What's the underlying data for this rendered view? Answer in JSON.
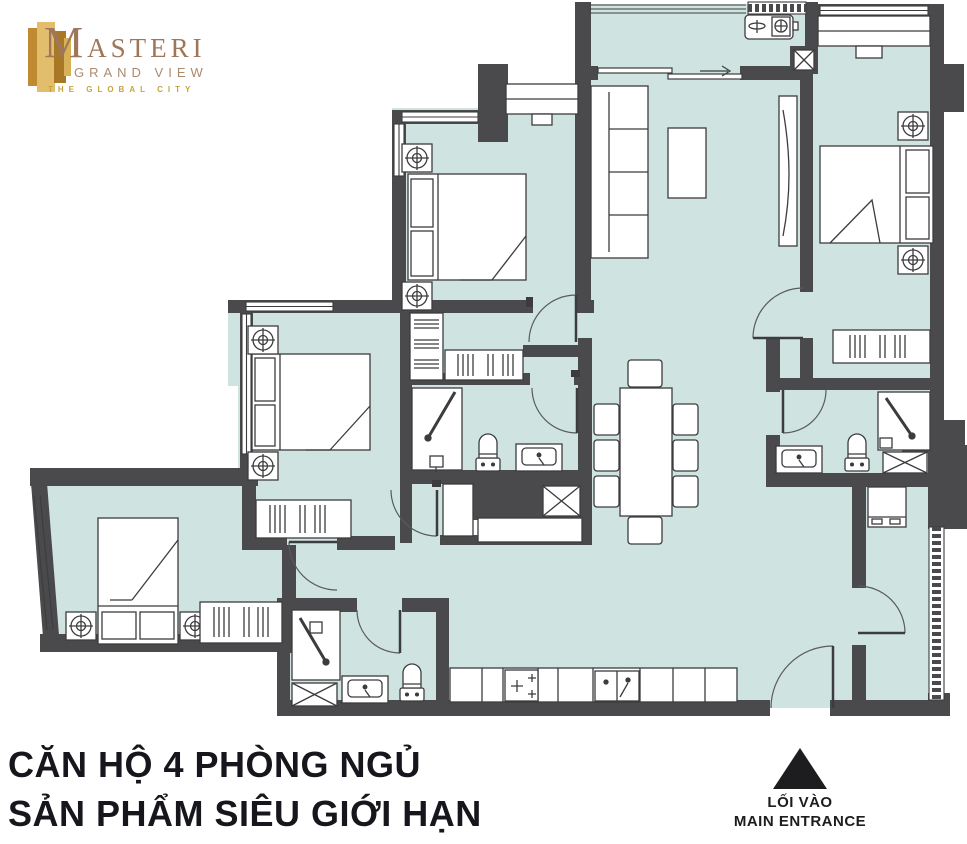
{
  "logo": {
    "m": "M",
    "rest": "ASTERI",
    "sub": "GRAND VIEW",
    "tagline": "THE GLOBAL CITY"
  },
  "caption": {
    "line1": "CĂN HỘ 4 PHÒNG NGỦ",
    "line2": "SẢN PHẨM SIÊU GIỚI HẠN"
  },
  "entrance": {
    "line1": "LỐI VÀO",
    "line2": "MAIN ENTRANCE"
  },
  "colors": {
    "floor": "#cfe4e0",
    "wall": "#4a4a4c",
    "furniture_outline": "#3c3c3e",
    "logo_gold": "#c8a43e",
    "logo_brown": "#a0765a",
    "caption_text": "#16161c"
  }
}
